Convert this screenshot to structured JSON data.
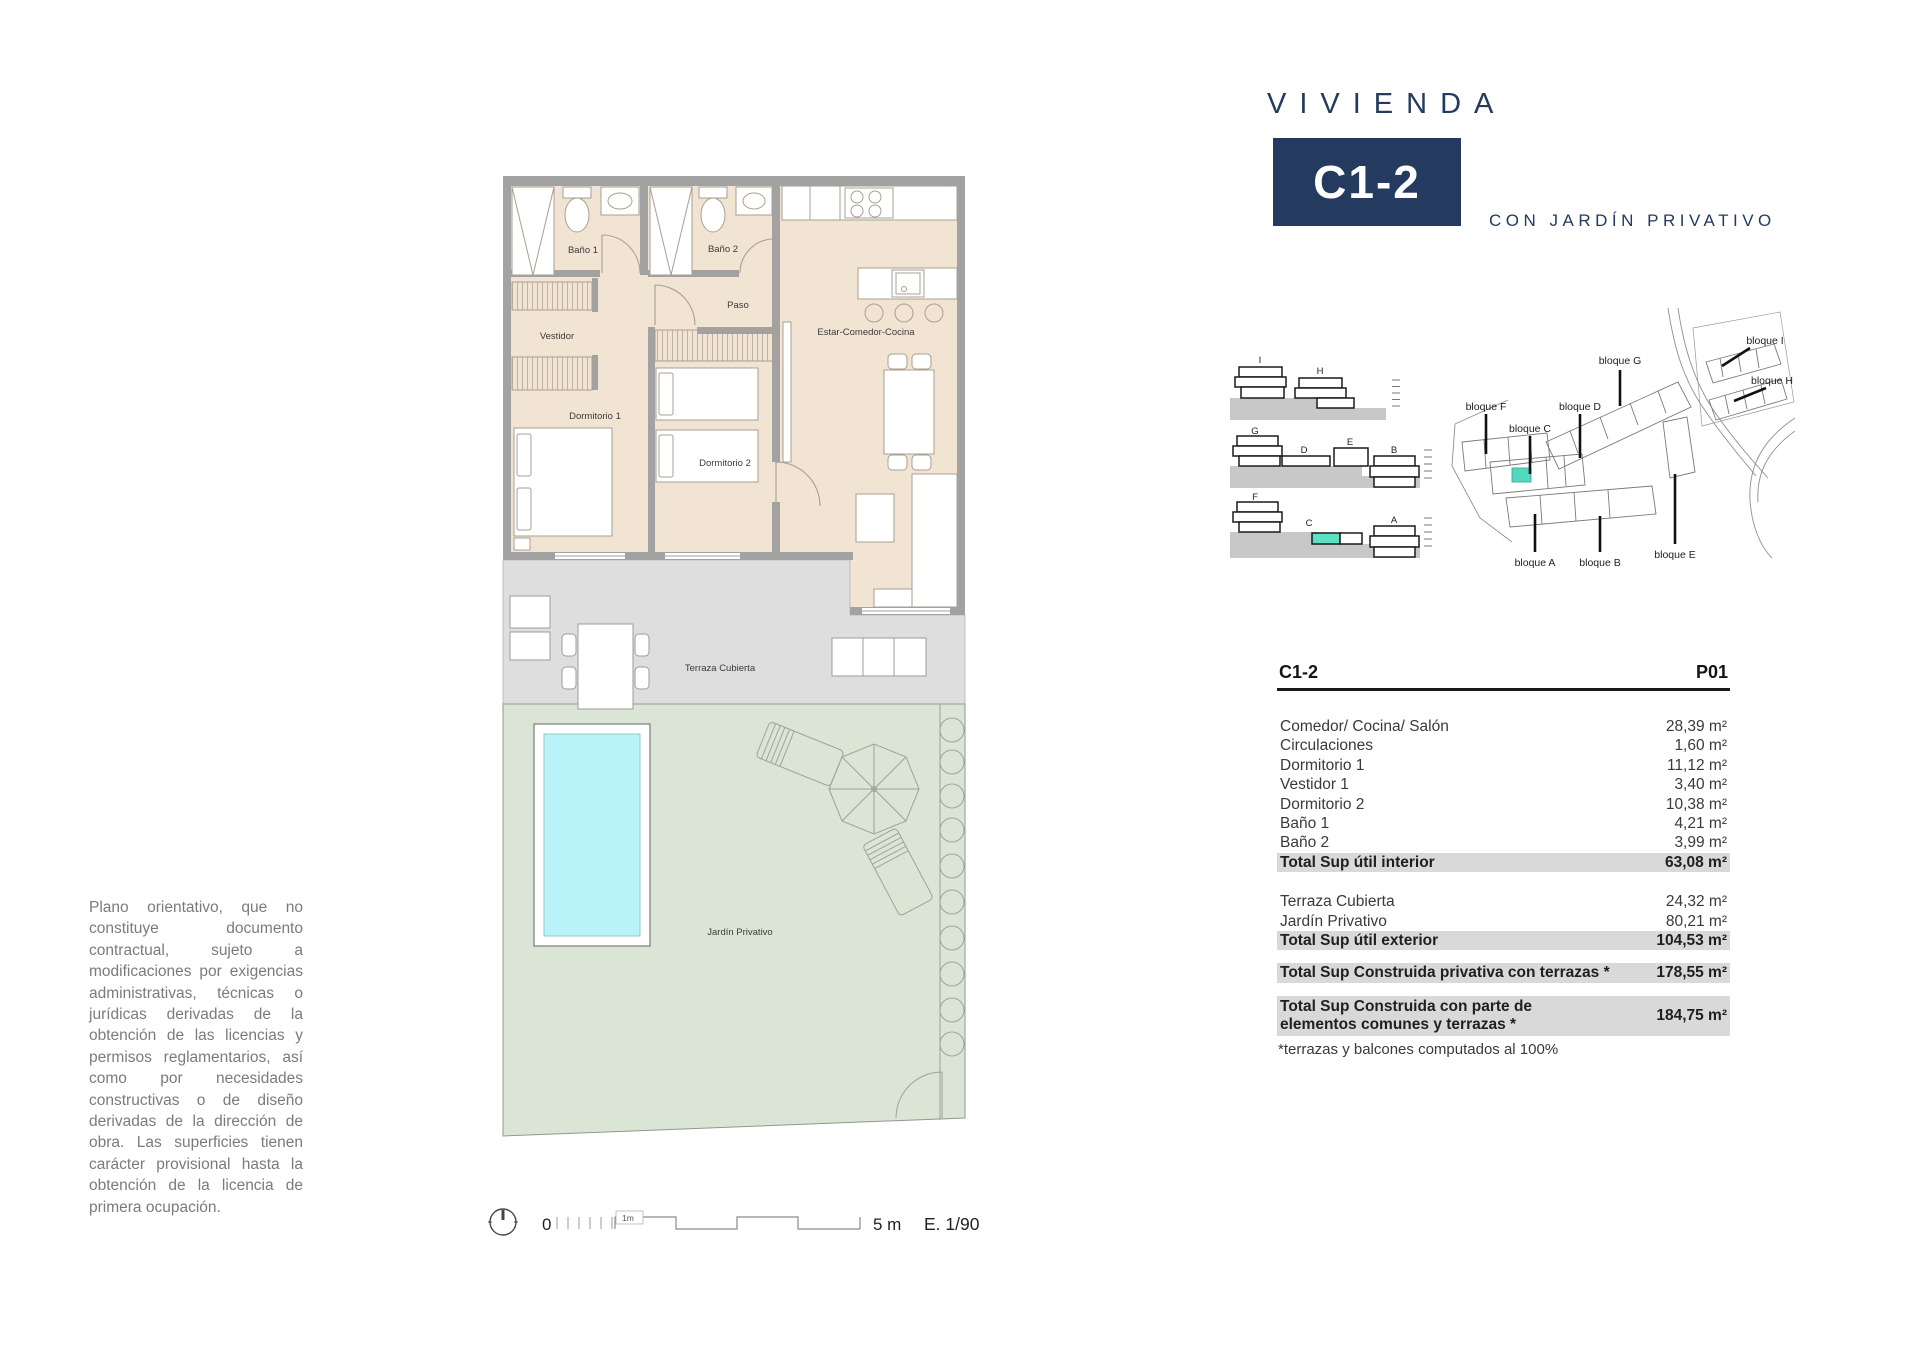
{
  "title": {
    "brand": "VIVIENDA",
    "unit": "C1-2",
    "subtitle": "CON JARDÍN PRIVATIVO",
    "accent_color": "#243a5e"
  },
  "disclaimer": {
    "text": "Plano orientativo, que no constituye documento contractual, sujeto a modificaciones por exigencias administrativas, técnicas o jurídicas derivadas de la obtención de las licencias y permisos reglamentarios, así como por necesidades constructivas o de diseño derivadas de la dirección de obra. Las superficies tienen carácter provisional hasta la obtención de la licencia de primera ocupación."
  },
  "floorplan": {
    "rooms": {
      "bano1": "Baño 1",
      "bano2": "Baño 2",
      "paso": "Paso",
      "vestidor": "Vestidor",
      "estar": "Estar-Comedor-Cocina",
      "dorm1": "Dormitorio 1",
      "dorm2": "Dormitorio 2",
      "terraza": "Terraza Cubierta",
      "jardin": "Jardín Privativo"
    },
    "colors": {
      "room_fill": "#f2e4d2",
      "wall": "#a2a2a2",
      "terrace": "#dedede",
      "garden": "#dbe5d6",
      "pool": "#b9f2f8"
    }
  },
  "sections": {
    "row1": [
      "I",
      "H"
    ],
    "row2": [
      "G",
      "D",
      "E",
      "B"
    ],
    "row3": [
      "F",
      "C",
      "A"
    ],
    "highlight_color": "#5fdfc4"
  },
  "siteplan": {
    "i": "bloque I",
    "h": "bloque H",
    "g": "bloque G",
    "d": "bloque D",
    "f": "bloque F",
    "c": "bloque C",
    "e": "bloque E",
    "a": "bloque A",
    "b": "bloque B",
    "highlight_color": "#52d8be"
  },
  "table": {
    "col_unit": "C1-2",
    "col_floor": "P01",
    "rows": [
      {
        "label": "Comedor/ Cocina/ Salón",
        "value": "28,39 m²"
      },
      {
        "label": "Circulaciones",
        "value": "1,60 m²"
      },
      {
        "label": "Dormitorio 1",
        "value": "11,12 m²"
      },
      {
        "label": "Vestidor 1",
        "value": "3,40 m²"
      },
      {
        "label": "Dormitorio 2",
        "value": "10,38 m²"
      },
      {
        "label": "Baño 1",
        "value": "4,21 m²"
      },
      {
        "label": "Baño 2",
        "value": "3,99 m²"
      },
      {
        "label": "Total Sup útil interior",
        "value": "63,08 m²"
      },
      {
        "label": "Terraza Cubierta",
        "value": "24,32 m²"
      },
      {
        "label": "Jardín Privativo",
        "value": "80,21 m²"
      },
      {
        "label": "Total Sup útil exterior",
        "value": "104,53 m²"
      },
      {
        "label": "Total Sup Construida privativa con terrazas *",
        "value": "178,55 m²"
      },
      {
        "label": "Total Sup Construida con parte de elementos comunes y terrazas *",
        "value": "184,75 m²"
      }
    ],
    "footnote": "*terrazas y balcones computados al 100%"
  },
  "scalebar": {
    "zero": "0",
    "one_m": "1m",
    "five_m": "5 m",
    "scale": "E. 1/90"
  }
}
